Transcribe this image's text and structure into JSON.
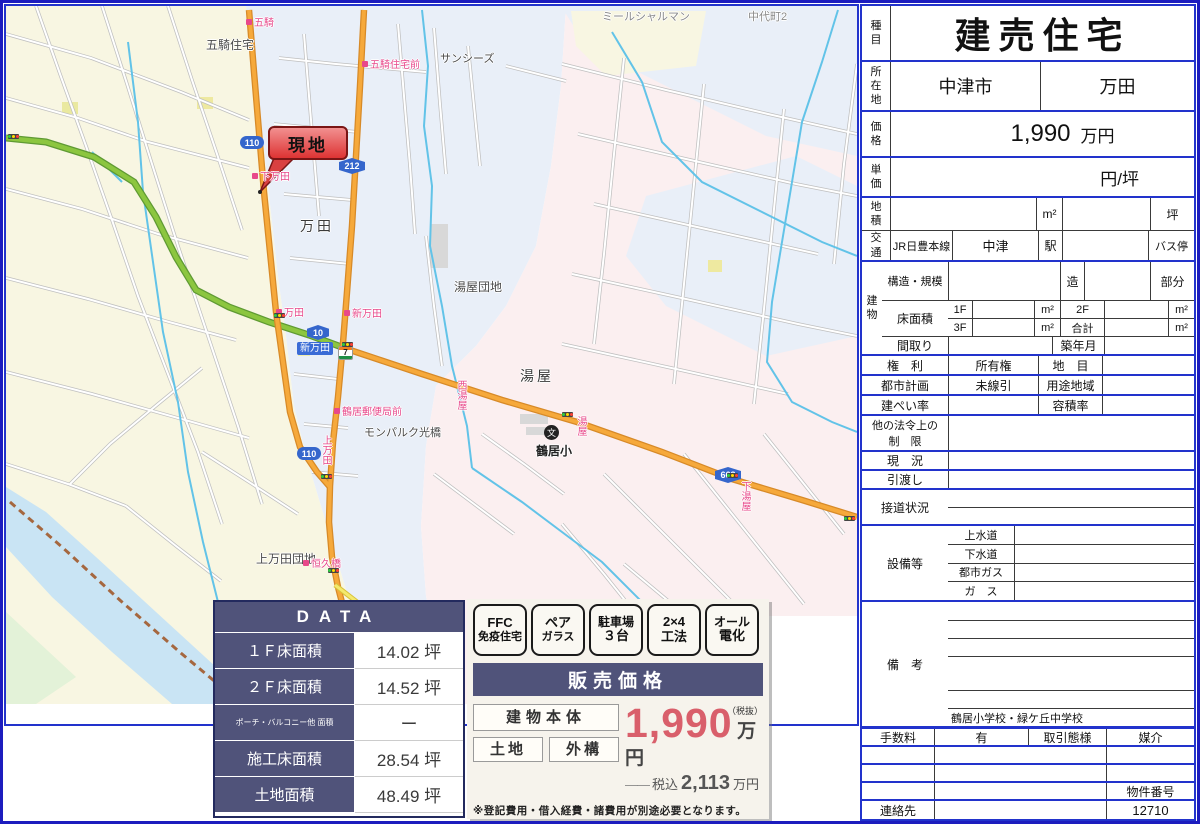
{
  "map": {
    "labels": {
      "goki_jutaku": "五騎住宅",
      "sunseas": "サンシーズ",
      "mille": "ミールシャルマン",
      "nakadai": "中代町2",
      "manda": "万田",
      "yuya_danchi": "湯屋団地",
      "yuya": "湯屋",
      "monparc": "モンパルク光橋",
      "tsurui_sho": "鶴居小",
      "kamimanda_danchi": "上万田団地"
    },
    "bus_stops": {
      "goki": "五騎",
      "goki_jutaku_mae": "五騎住宅前",
      "shimomanda": "下万田",
      "manda": "万田",
      "shin_manda": "新万田",
      "yubinkyoku_mae": "鶴居郵便局前",
      "nishi_yuya": "西湯屋",
      "yuya": "湯屋",
      "shimo_yuya": "下湯屋",
      "kami_manda": "上万田",
      "kokyubashi": "恒久橋"
    },
    "badges": {
      "r110": "110",
      "r212": "212",
      "r10": "10",
      "r663": "663",
      "r110b": "110"
    },
    "intersection": "新万田",
    "callout": "現地",
    "seven": "7",
    "school_mark": "文"
  },
  "data_table": {
    "header": "DATA",
    "rows": [
      {
        "label": "１Ｆ床面積",
        "value": "14.02 坪"
      },
      {
        "label": "２Ｆ床面積",
        "value": "14.52 坪"
      },
      {
        "label": "ポーチ・バルコニー他 面積",
        "value": "ー"
      },
      {
        "label": "施工床面積",
        "value": "28.54 坪"
      },
      {
        "label": "土地面積",
        "value": "48.49 坪"
      }
    ]
  },
  "price_panel": {
    "badges": [
      {
        "line1": "FFC",
        "line2": "免疫住宅"
      },
      {
        "line1": "ペア",
        "line2": "ガラス"
      },
      {
        "line1": "駐車場",
        "line2": "３台"
      },
      {
        "line1": "2×4",
        "line2": "工法"
      },
      {
        "line1": "オール",
        "line2": "電化"
      }
    ],
    "header": "販売価格",
    "item_main": "建物本体",
    "item_sub1": "土地",
    "item_sub2": "外構",
    "price": "1,990",
    "price_unit": "万円",
    "tax_free_note": "（税抜）",
    "dash": "――",
    "tax_included_label": "税込",
    "tax_included_price": "2,113",
    "tax_included_unit": "万円",
    "note": "※登記費用・借入経費・諸費用が別途必要となります。"
  },
  "spec": {
    "shumoku_label": "種\n目",
    "shumoku": "建売住宅",
    "shozaichi_label": "所\n在\n地",
    "city": "中津市",
    "town": "万田",
    "kakaku_label": "価\n格",
    "price": "1,990",
    "price_unit": "万円",
    "tanka_label": "単\n価",
    "tanka_unit": "円/坪",
    "chiseki_label": "地\n積",
    "m2": "m²",
    "tsubo": "坪",
    "kotsu_label": "交\n通",
    "rail_line": "JR日豊本線",
    "station": "中津",
    "eki": "駅",
    "bus_stop": "バス停",
    "tatemono_label": "建\n物",
    "kozo_label": "構造・規模",
    "zo": "造",
    "bubun": "部分",
    "yuka_label": "床面積",
    "f1": "1F",
    "f2": "2F",
    "f3": "3F",
    "gokei": "合計",
    "madori_label": "間取り",
    "chikunengetsu_label": "築年月",
    "kenri_label": "権　利",
    "kenri": "所有権",
    "chimoku_label": "地　目",
    "toshi_label": "都市計画",
    "toshi": "未線引",
    "yoto_label": "用途地域",
    "kenpei_label": "建ぺい率",
    "yoseki_label": "容積率",
    "hoki_label": "他の法令上の\n制　限",
    "genkyo_label": "現　況",
    "hikiwatashi_label": "引渡し",
    "setsudo_label": "接道状況",
    "setsubi_label": "設備等",
    "josui": "上水道",
    "gesui": "下水道",
    "toshigas": "都市ガス",
    "gas": "ガ　ス",
    "biko_label": "備　考",
    "schools": "鶴居小学校・緑ケ丘中学校",
    "tesuryo_label": "手数料",
    "tesuryo": "有",
    "torihiki_label": "取引態様",
    "baikai": "媒介",
    "bukken_label": "物件番号",
    "bukken_no": "12710",
    "renraku_label": "連絡先"
  }
}
